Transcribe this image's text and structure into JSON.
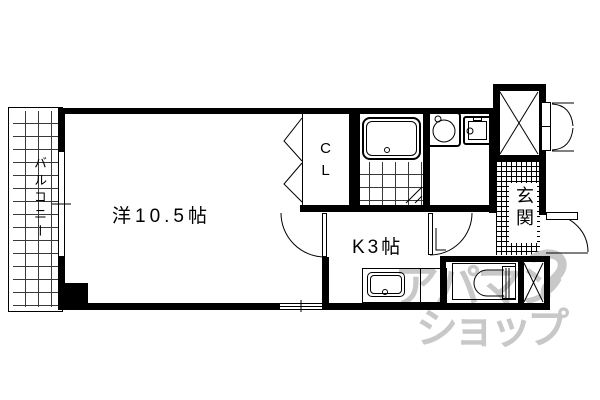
{
  "document": {
    "type": "apartment-floor-plan",
    "background_color": "#ffffff",
    "line_color": "#000000"
  },
  "rooms": {
    "main": {
      "label": "洋10.5帖"
    },
    "kitchen": {
      "label": "K3帖"
    },
    "closet": {
      "label": "CL"
    },
    "balcony": {
      "label": "バルコニー"
    },
    "entrance": {
      "label": "玄関"
    }
  },
  "fixtures": [
    "bathtub",
    "bathroom-tile-floor",
    "washing-machine",
    "wash-basin",
    "kitchen-sink-counter",
    "toilet",
    "elevator-shaft",
    "pipe-shaft",
    "balcony-window",
    "kitchen-window",
    "entrance-door",
    "elevator-double-door",
    "room-kitchen-door",
    "hall-door",
    "closet-bifold-door",
    "bathroom-folding-door"
  ],
  "watermark": {
    "line1": "アパマン",
    "line2": "ショップ",
    "color": "#c8c8c8"
  }
}
